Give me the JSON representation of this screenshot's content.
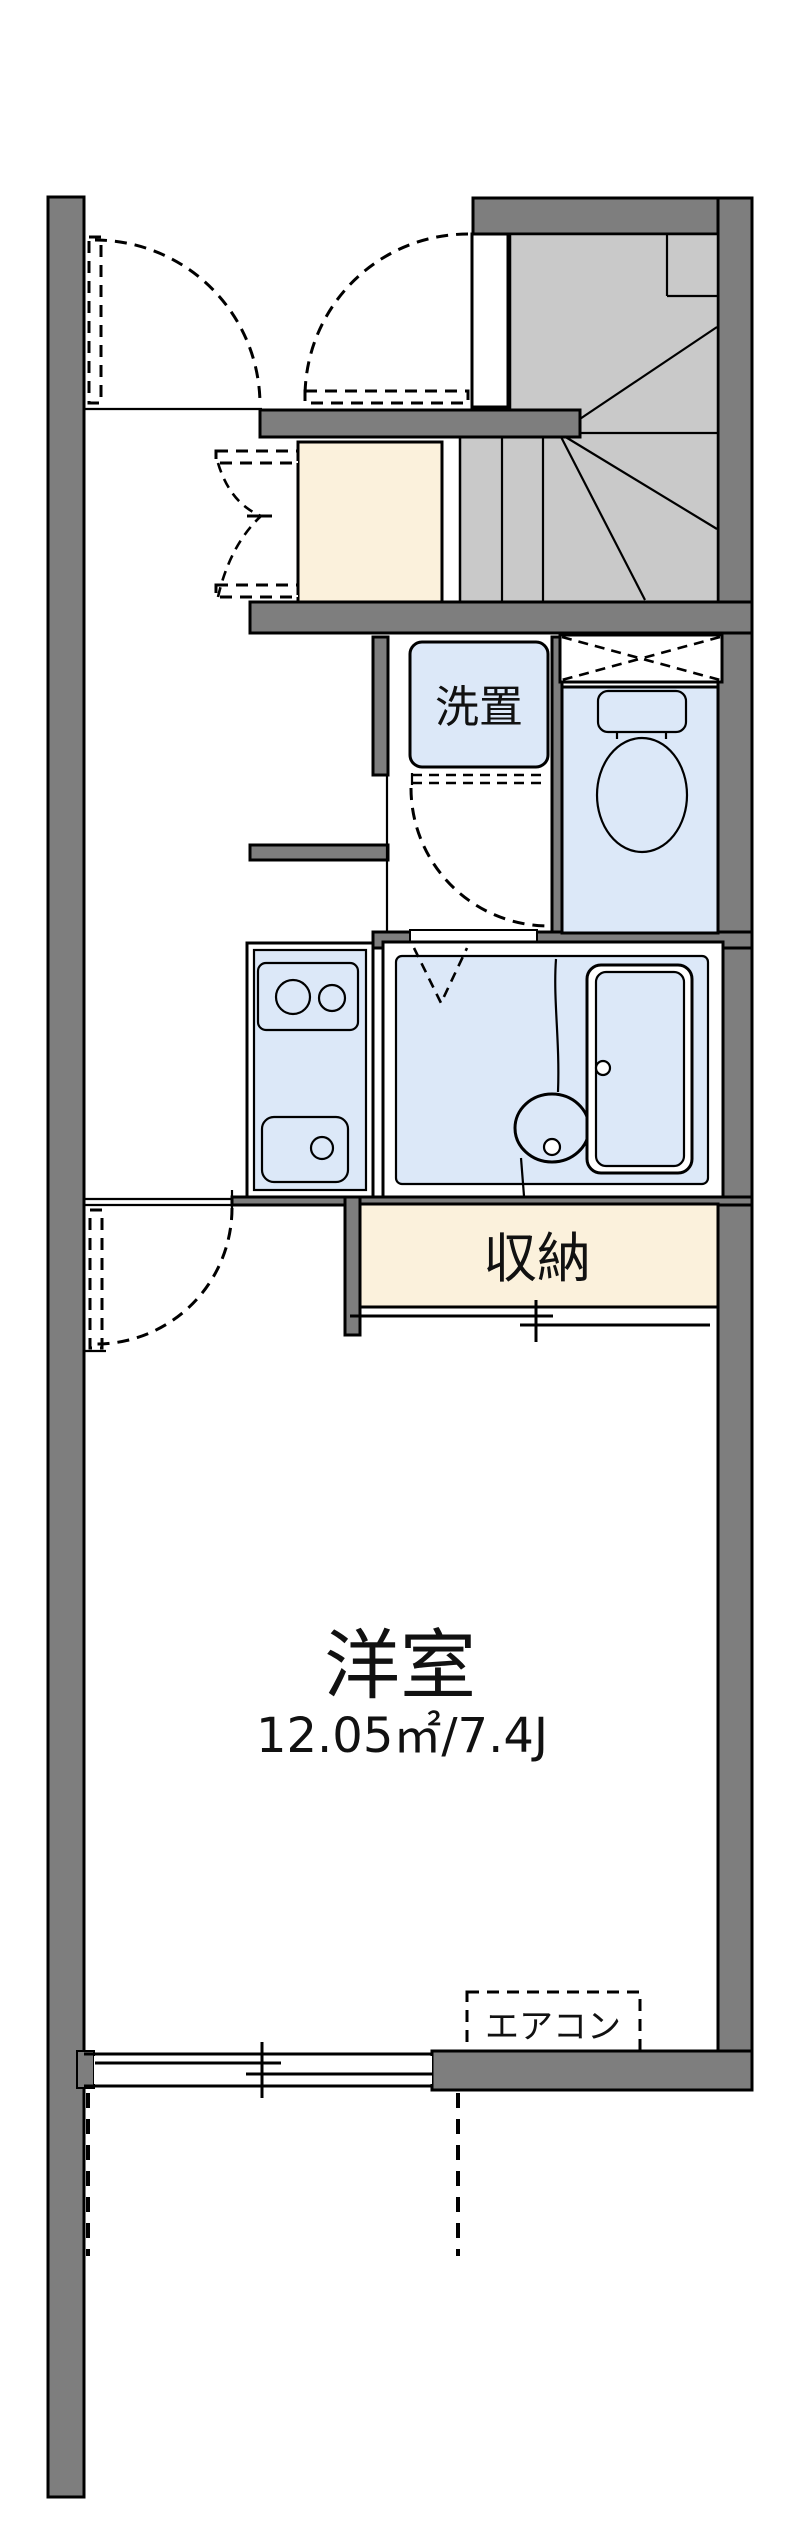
{
  "document": {
    "type": "japanese-apartment-floor-plan"
  },
  "labels": {
    "washer_place": "洗置",
    "storage": "収納",
    "main_room": "洋室",
    "main_room_size": "12.05㎡/7.4J",
    "air_conditioner": "エアコン"
  },
  "main_room": {
    "name": "洋室",
    "area_m2": "12.05",
    "size_tatami": "7.4J"
  },
  "colors": {
    "wall": "#7e7e7e",
    "stairs": "#c9c9c9",
    "fixture_blue": "#dce8f8",
    "closet_cream": "#fbf1dc",
    "line": "#000000",
    "background": "#ffffff"
  }
}
